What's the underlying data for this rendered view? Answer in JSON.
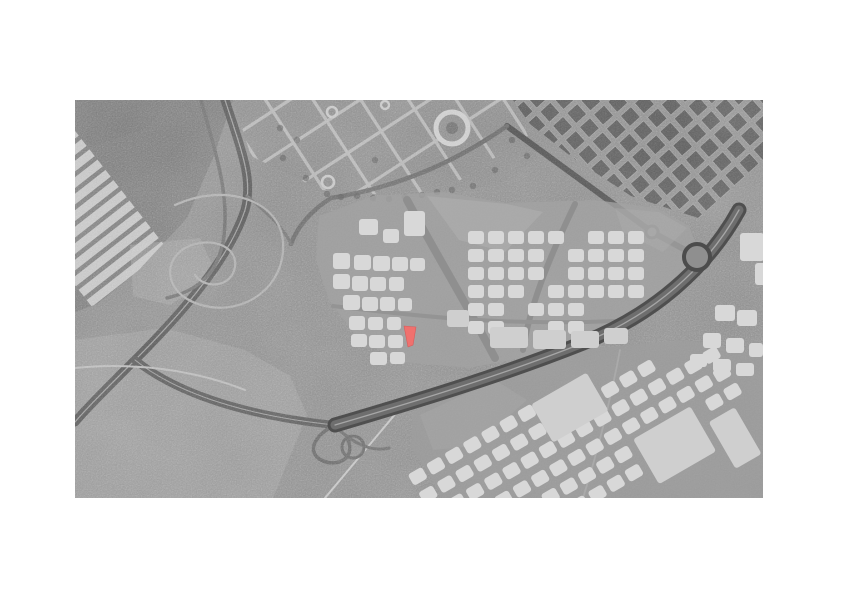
{
  "meta": {
    "description": "Grayscale aerial photograph with urban masterplan block overlay and one parcel highlighted in red",
    "canvas": {
      "width": 842,
      "height": 595,
      "background": "#ffffff"
    }
  },
  "map": {
    "position": {
      "x": 75,
      "y": 100,
      "width": 688,
      "height": 398
    },
    "palette": {
      "base": "#8d8d8d",
      "block": "#d8d8d8",
      "block_big": "#cfcfcf",
      "warehouse": "#c9c9c9",
      "city_block": "#5e5e5e",
      "city_block_edge": "#9e9e9e",
      "highlight": "#f0716e",
      "highlight_edge": "#d85b5b"
    },
    "texture": {
      "fine": {
        "freq": 0.8,
        "oct": 2,
        "opacity": 0.45,
        "blend": "overlay"
      },
      "coarse": {
        "freq": 0.012,
        "oct": 4,
        "opacity": 0.4,
        "blend": "soft-light"
      }
    },
    "photo_zones": [
      {
        "id": "trees-topleft",
        "points": "0,0 96,0 72,28 20,46 0,42",
        "fill": "#6c6c6c",
        "opacity": 0.9
      },
      {
        "id": "industrial",
        "points": "0,0 158,0 138,58 112,118 62,172 22,204 0,212",
        "fill": "#7b7b7b",
        "opacity": 0.92,
        "clip": true
      },
      {
        "id": "park",
        "points": "158,0 438,0 462,58 425,84 338,97 246,90 176,56",
        "fill": "#8b8b8b",
        "opacity": 0.9,
        "clip": true
      },
      {
        "id": "city",
        "points": "438,0 688,0 688,132 636,122 598,110 556,96 498,58 455,24",
        "fill": "#8e8e8e",
        "opacity": 0.95,
        "clip": true
      },
      {
        "id": "leftfield",
        "points": "0,240 90,228 170,250 215,276 232,315 198,398 0,398",
        "fill": "#a4a4a4",
        "opacity": 0.5
      },
      {
        "id": "mound-field",
        "points": "55,145 125,138 142,175 95,205 58,196",
        "fill": "#a8a8a8",
        "opacity": 0.45
      }
    ],
    "warehouses": {
      "rotate": [
        -38,
        55,
        85
      ],
      "clip": "industrial",
      "x": -50,
      "w": 95,
      "y0": -20,
      "y1": 150,
      "dy": 13,
      "h": 8.5,
      "fill": "#c9c9c9",
      "opacity": 0.92
    },
    "park_grid": {
      "rotate": [
        -33,
        300,
        40
      ],
      "clip": "park",
      "stroke": "#b4b4b4",
      "w": 3.2,
      "v": {
        "x0": 150,
        "x1": 500,
        "dx": 40,
        "y0": -70,
        "y1": 120
      },
      "h": {
        "y0": -40,
        "y1": 100,
        "dy": 38,
        "x0": 140,
        "x1": 500
      }
    },
    "city_grid": {
      "rotate": [
        -42,
        560,
        50
      ],
      "clip": "city",
      "x0": 420,
      "x1": 720,
      "dx": 19,
      "y0": -80,
      "y1": 130,
      "dy": 19,
      "w": 14,
      "h": 14
    },
    "photo_roads": [
      {
        "id": "motorway-north",
        "d": "M150,0 C168,55 178,80 170,110 C152,165 95,225 60,260 C30,290 10,310 0,322",
        "stroke": "#5c5c5c",
        "w": 9,
        "center": [
          "#9c9c9c",
          1.2
        ]
      },
      {
        "id": "motorway-west-link",
        "d": "M60,260 C110,300 190,318 260,325",
        "stroke": "#5f5f5f",
        "w": 8,
        "center": [
          "#9a9a9a",
          1
        ]
      },
      {
        "id": "local-road-west",
        "d": "M126,0 C140,52 156,96 148,142 C141,178 118,192 92,198",
        "stroke": "#707070",
        "w": 3.5
      },
      {
        "id": "boulevard-east",
        "d": "M432,26 C468,52 522,92 577,132 L614,152",
        "stroke": "#565656",
        "w": 6
      },
      {
        "id": "park-edge-road",
        "d": "M432,26 C386,58 330,86 256,98 C234,112 222,128 216,144",
        "stroke": "#6d6d6d",
        "w": 4.5
      },
      {
        "id": "link-road",
        "d": "M172,96 C196,116 210,130 216,144",
        "stroke": "#777777",
        "w": 3
      },
      {
        "id": "field-track",
        "d": "M0,268 C60,262 120,270 170,290",
        "stroke": "#b8b8b8",
        "w": 2
      },
      {
        "id": "south-track-1",
        "d": "M250,398 L332,300",
        "stroke": "#c2c2c2",
        "w": 2
      },
      {
        "id": "south-track-2",
        "d": "M545,250 C534,308 520,360 508,398",
        "stroke": "#c6c6c6",
        "w": 1.8
      },
      {
        "id": "mound-trails",
        "d": "M100,105 C150,82 205,100 208,142 C211,188 168,215 130,206 C90,197 86,162 110,148 C132,136 163,144 160,167 C157,187 130,190 120,175",
        "stroke": "#ababab",
        "w": 2.2
      },
      {
        "id": "interchange-ramp-1",
        "d": "M260,325 C238,336 232,352 246,360 C264,369 282,356 272,338",
        "stroke": "#6a6a6a",
        "w": 3.5
      },
      {
        "id": "interchange-ramp-2",
        "d": "M262,328 C280,345 298,352 314,348",
        "stroke": "#6e6e6e",
        "w": 3
      }
    ],
    "circles": [
      {
        "id": "park-plaza-ring",
        "cx": 377,
        "cy": 28,
        "r": 16,
        "fill": "#8e8e8e",
        "stroke": "#cccccc",
        "w": 5
      },
      {
        "id": "park-plaza-core",
        "cx": 377,
        "cy": 28,
        "r": 6,
        "fill": "#747474"
      },
      {
        "id": "park-roundabout-1",
        "cx": 257,
        "cy": 12,
        "r": 5,
        "stroke": "#c4c4c4",
        "w": 2.6
      },
      {
        "id": "park-roundabout-2",
        "cx": 253,
        "cy": 82,
        "r": 6,
        "stroke": "#c4c4c4",
        "w": 2.6
      },
      {
        "id": "park-roundabout-3",
        "cx": 310,
        "cy": 5,
        "r": 4,
        "stroke": "#c4c4c4",
        "w": 2.4
      },
      {
        "id": "boulevard-roundabout",
        "cx": 577,
        "cy": 132,
        "r": 6,
        "fill": "#9a9a9a",
        "stroke": "#545454",
        "w": 3
      },
      {
        "id": "interchange-loop",
        "cx": 278,
        "cy": 347,
        "r": 11,
        "stroke": "#6a6a6a",
        "w": 3
      }
    ],
    "trees": {
      "fill": "#616161",
      "opacity": 0.65,
      "r": 3.2,
      "pts": [
        [
          252,
          94
        ],
        [
          266,
          97
        ],
        [
          282,
          96
        ],
        [
          298,
          98
        ],
        [
          314,
          99
        ],
        [
          330,
          97
        ],
        [
          347,
          95
        ],
        [
          362,
          92
        ],
        [
          377,
          90
        ],
        [
          231,
          78
        ],
        [
          208,
          58
        ],
        [
          300,
          60
        ],
        [
          398,
          86
        ],
        [
          420,
          70
        ],
        [
          437,
          40
        ],
        [
          452,
          56
        ],
        [
          205,
          28
        ],
        [
          222,
          40
        ]
      ]
    },
    "overlay_zones": [
      {
        "id": "masterplan-centre",
        "points": "244,116 298,96 368,92 430,103 520,100 582,108 614,126 624,152 600,186 544,224 468,254 394,268 328,262 284,240 254,200 241,160",
        "fill": "#a3a3a3",
        "opacity": 0.8
      },
      {
        "id": "masterplan-south",
        "points": "338,312 420,276 520,248 612,240 688,256 688,398 368,398 336,346",
        "fill": "#9d9d9d",
        "opacity": 0.75
      },
      {
        "id": "open-field-north",
        "points": "352,96 432,104 468,112 430,152 384,140",
        "fill": "#b2b2b2",
        "opacity": 0.5
      },
      {
        "id": "open-field-east",
        "points": "540,108 584,112 612,128 588,152 548,132",
        "fill": "#b0b0b0",
        "opacity": 0.4
      },
      {
        "id": "open-field-south",
        "points": "345,315 420,280 452,300 400,346 358,350",
        "fill": "#ababab",
        "opacity": 0.4
      }
    ],
    "overlay_roads": [
      {
        "id": "avenue-diag-1",
        "d": "M332,100 C360,152 392,205 420,258",
        "stroke": "#8f8f8f",
        "w": 8
      },
      {
        "id": "avenue-diag-2",
        "d": "M500,104 C474,158 455,205 448,250",
        "stroke": "#8f8f8f",
        "w": 6
      },
      {
        "id": "avenue-cross",
        "d": "M258,206 C340,216 430,226 540,221",
        "stroke": "#949494",
        "w": 4
      }
    ],
    "highway": {
      "id": "motorway-south",
      "d": "M260,325 C335,303 425,276 508,243 C578,215 632,168 664,110",
      "casing": "#4f4f4f",
      "cw": 15,
      "inner": "#6e6e6e",
      "iw": 9,
      "line": "#a6a6a6",
      "lw": 1.3
    },
    "highway_roundabout": {
      "cx": 622,
      "cy": 157,
      "r": 13,
      "fill": "#8f8f8f",
      "stroke": "#4c4c4c",
      "w": 4
    },
    "blocks": {
      "west": [
        [
          284,
          119,
          19,
          16
        ],
        [
          308,
          129,
          16,
          14
        ],
        [
          329,
          111,
          21,
          25
        ],
        [
          258,
          153,
          17,
          16
        ],
        [
          279,
          155,
          17,
          15
        ],
        [
          298,
          156,
          17,
          15
        ],
        [
          317,
          157,
          16,
          14
        ],
        [
          335,
          158,
          15,
          13
        ],
        [
          258,
          174,
          17,
          15
        ],
        [
          277,
          176,
          16,
          15
        ],
        [
          295,
          177,
          16,
          14
        ],
        [
          314,
          177,
          15,
          14
        ],
        [
          268,
          195,
          17,
          15
        ],
        [
          287,
          197,
          16,
          14
        ],
        [
          305,
          197,
          15,
          14
        ],
        [
          323,
          198,
          14,
          13
        ],
        [
          274,
          216,
          16,
          14
        ],
        [
          293,
          217,
          15,
          13
        ],
        [
          312,
          217,
          14,
          13
        ],
        [
          276,
          234,
          16,
          13
        ],
        [
          294,
          235,
          16,
          13
        ],
        [
          313,
          235,
          15,
          13
        ],
        [
          295,
          252,
          17,
          13
        ],
        [
          315,
          252,
          15,
          12
        ]
      ],
      "east_grid": {
        "x0": 393,
        "dx": 20,
        "cols": 9,
        "rows": [
          131,
          149,
          167,
          185,
          203,
          221
        ],
        "w": 16,
        "h": 13,
        "skips": [
          [
            5,
            0
          ],
          [
            4,
            1
          ],
          [
            4,
            2
          ],
          [
            3,
            3
          ],
          [
            2,
            4
          ],
          [
            6,
            4
          ],
          [
            7,
            4
          ],
          [
            8,
            4
          ],
          [
            2,
            5
          ],
          [
            3,
            5
          ],
          [
            6,
            5
          ],
          [
            7,
            5
          ],
          [
            8,
            5
          ]
        ]
      },
      "east_big": [
        [
          372,
          210,
          22,
          17
        ],
        [
          415,
          227,
          38,
          21
        ],
        [
          458,
          230,
          33,
          19
        ],
        [
          496,
          231,
          28,
          17
        ],
        [
          529,
          228,
          24,
          16
        ]
      ],
      "edge": [
        [
          665,
          133,
          24,
          28
        ],
        [
          680,
          163,
          14,
          22
        ],
        [
          640,
          205,
          20,
          16
        ],
        [
          662,
          210,
          20,
          16
        ],
        [
          628,
          233,
          18,
          15
        ],
        [
          651,
          238,
          18,
          15
        ],
        [
          674,
          243,
          14,
          14
        ],
        [
          615,
          254,
          17,
          13
        ],
        [
          638,
          259,
          18,
          13
        ],
        [
          661,
          263,
          18,
          13
        ]
      ]
    },
    "south_blocks": {
      "rotate": [
        -30,
        480,
        330
      ],
      "x0": 330,
      "dx": 21,
      "w": 16,
      "h": 13,
      "rows": [
        {
          "y": 295,
          "i0": 0,
          "i1": 8
        },
        {
          "y": 316,
          "i0": 0,
          "i1": 12
        },
        {
          "y": 337,
          "i0": 0,
          "i1": 15
        },
        {
          "y": 358,
          "i0": 2,
          "i1": 15
        },
        {
          "y": 379,
          "i0": 3,
          "i1": 15
        },
        {
          "y": 400,
          "i0": 6,
          "i1": 14
        }
      ],
      "skips": [
        [
          7,
          0
        ],
        [
          8,
          0
        ],
        [
          9,
          0
        ],
        [
          7,
          1
        ],
        [
          8,
          1
        ],
        [
          9,
          1
        ],
        [
          10,
          4
        ],
        [
          11,
          4
        ],
        [
          12,
          4
        ],
        [
          13,
          4
        ],
        [
          10,
          5
        ],
        [
          11,
          5
        ],
        [
          12,
          5
        ],
        [
          13,
          5
        ],
        [
          14,
          5
        ]
      ],
      "big": [
        [
          472,
          296,
          64,
          44
        ],
        [
          543,
          377,
          66,
          52
        ],
        [
          617,
          400,
          30,
          54
        ]
      ]
    },
    "highlighted_parcel": {
      "points": "329,226 341,227 338,245 333,247",
      "fill": "#f0716e",
      "stroke": "#d85b5b"
    }
  }
}
